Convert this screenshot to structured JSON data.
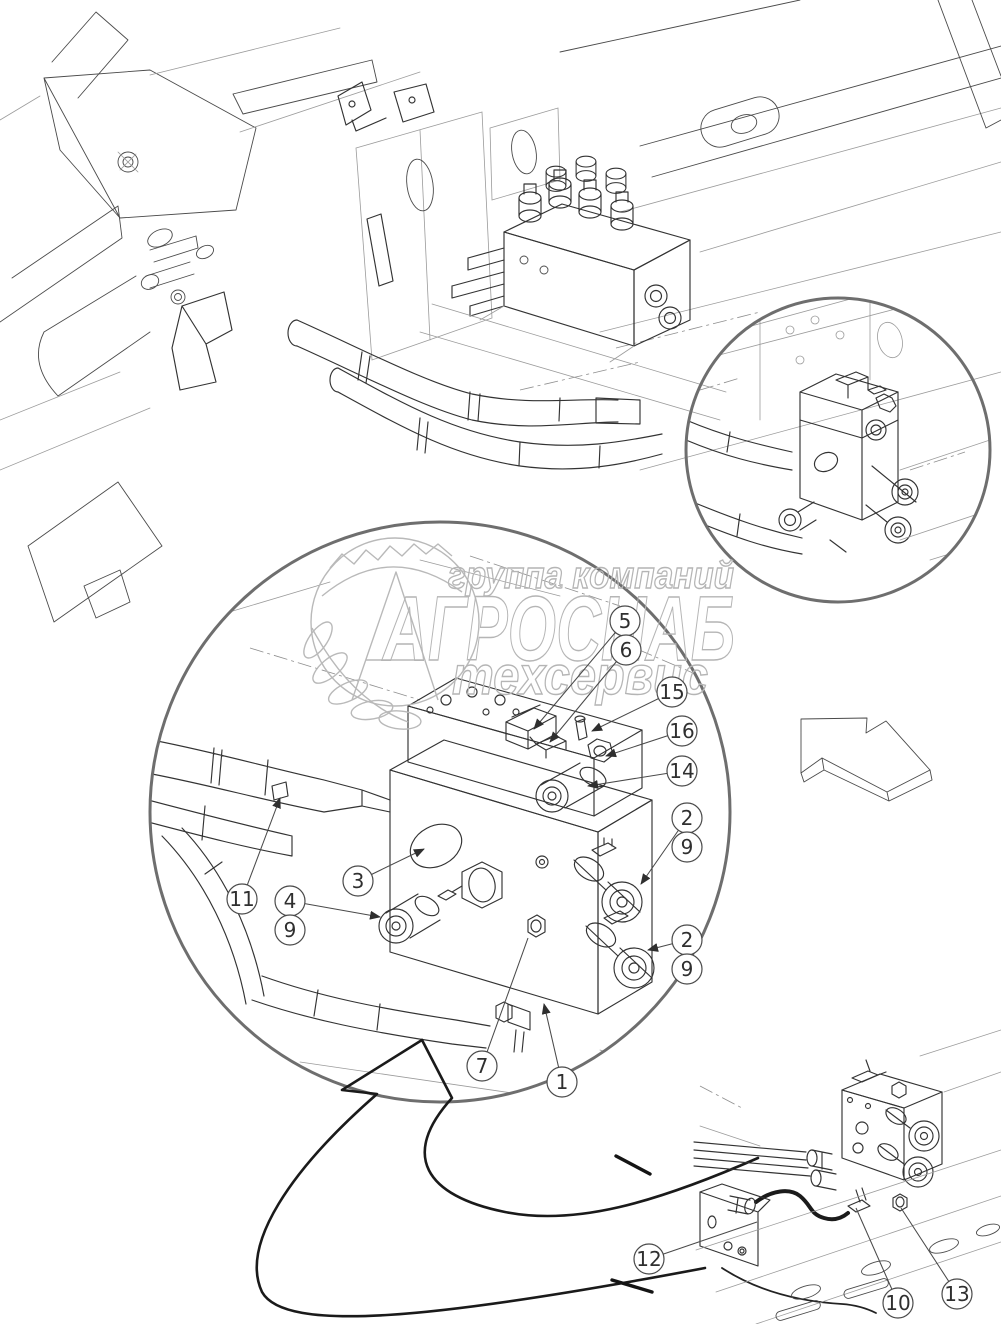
{
  "page": {
    "width": 1001,
    "height": 1324,
    "background": "#ffffff"
  },
  "watermark": {
    "line1": "группа компаний",
    "line2": "АГРОСНАБ",
    "line3": "техсервис",
    "color": "#b5b5b5"
  },
  "colors": {
    "line_dark": "#333333",
    "line_light": "#9b9b9b",
    "detail_circle_stroke": "#6e6e6e",
    "bold_line": "#141414",
    "background": "#ffffff"
  },
  "callouts": {
    "style": {
      "radius": 15,
      "stroke": "#4a4a4a",
      "text_color": "#2f2f2f"
    },
    "items": [
      {
        "label": "5",
        "x": 625,
        "y": 621,
        "tx": 534,
        "ty": 729,
        "arrow": true
      },
      {
        "label": "6",
        "x": 626,
        "y": 650,
        "tx": 550,
        "ty": 742,
        "arrow": true
      },
      {
        "label": "15",
        "x": 672,
        "y": 692,
        "tx": 592,
        "ty": 731,
        "arrow": true
      },
      {
        "label": "16",
        "x": 682,
        "y": 731,
        "tx": 606,
        "ty": 756,
        "arrow": true
      },
      {
        "label": "14",
        "x": 682,
        "y": 771,
        "tx": 588,
        "ty": 786,
        "arrow": true
      },
      {
        "label": "2",
        "x": 687,
        "y": 818,
        "tx": 641,
        "ty": 884,
        "arrow": true
      },
      {
        "label": "9",
        "x": 687,
        "y": 847,
        "arrow": false
      },
      {
        "label": "2",
        "x": 687,
        "y": 940,
        "tx": 648,
        "ty": 950,
        "arrow": true
      },
      {
        "label": "9",
        "x": 687,
        "y": 969,
        "arrow": false
      },
      {
        "label": "11",
        "x": 242,
        "y": 899,
        "tx": 280,
        "ty": 798,
        "arrow": true
      },
      {
        "label": "3",
        "x": 358,
        "y": 881,
        "tx": 424,
        "ty": 849,
        "arrow": true
      },
      {
        "label": "4",
        "x": 290,
        "y": 901,
        "tx": 380,
        "ty": 917,
        "arrow": true
      },
      {
        "label": "9",
        "x": 290,
        "y": 930,
        "arrow": false
      },
      {
        "label": "7",
        "x": 482,
        "y": 1066,
        "tx": 528,
        "ty": 938,
        "arrow": false
      },
      {
        "label": "1",
        "x": 562,
        "y": 1082,
        "tx": 544,
        "ty": 1004,
        "arrow": true
      },
      {
        "label": "12",
        "x": 649,
        "y": 1259,
        "tx": 757,
        "ty": 1222,
        "arrow": false
      },
      {
        "label": "10",
        "x": 898,
        "y": 1303,
        "tx": 856,
        "ty": 1208,
        "arrow": false
      },
      {
        "label": "13",
        "x": 957,
        "y": 1294,
        "tx": 901,
        "ty": 1208,
        "arrow": false
      }
    ]
  }
}
